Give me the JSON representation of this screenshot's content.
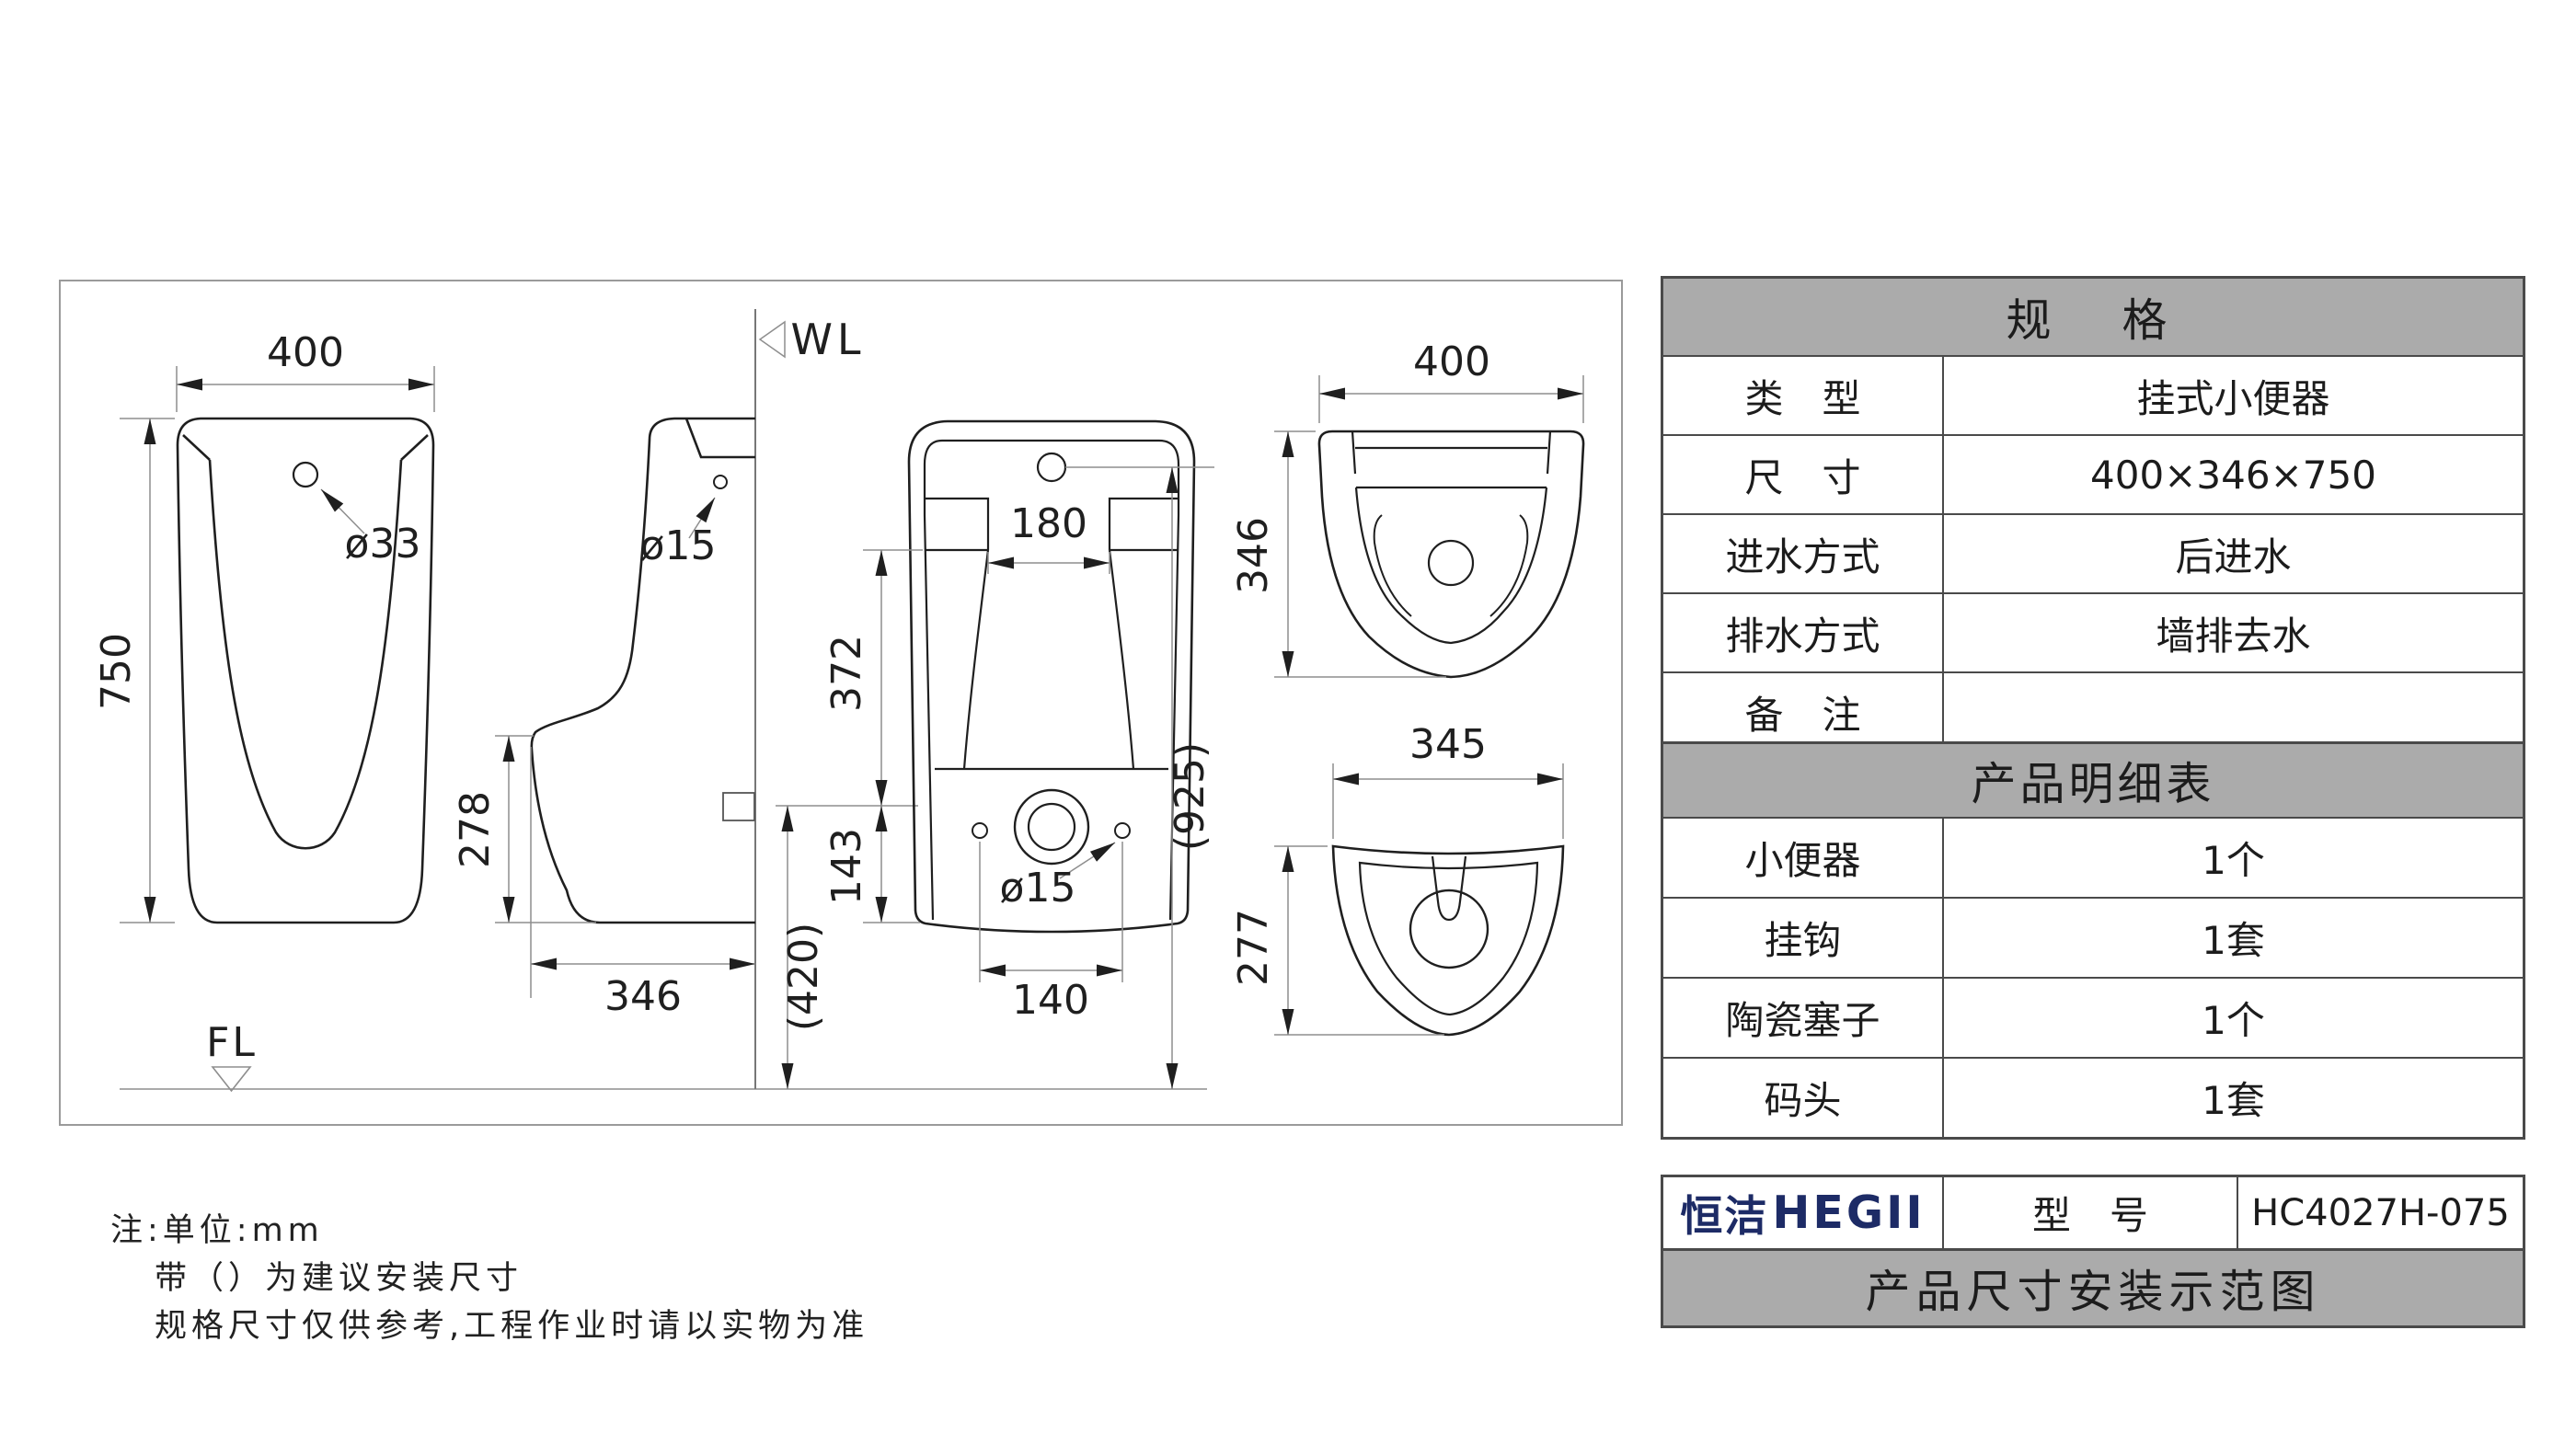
{
  "drawing": {
    "front_view": {
      "width": "400",
      "height": "750",
      "inlet_hole": "ø33",
      "floor_label": "FL"
    },
    "side_view": {
      "hole": "ø15",
      "depth_lower": "278",
      "bottom_depth": "346",
      "wall_label": "WL",
      "outlet_height": "(420)"
    },
    "rear_view": {
      "opening": "180",
      "upper": "372",
      "lower": "143",
      "holes": "ø15",
      "hole_spacing": "140",
      "inlet_height": "(925)"
    },
    "top_view": {
      "width": "400",
      "depth": "346"
    },
    "bottom_view": {
      "width": "345",
      "depth": "277"
    }
  },
  "spec_table": {
    "title": "规　格",
    "rows": [
      {
        "label": "类　型",
        "value": "挂式小便器"
      },
      {
        "label": "尺　寸",
        "value": "400×346×750"
      },
      {
        "label": "进水方式",
        "value": "后进水"
      },
      {
        "label": "排水方式",
        "value": "墙排去水"
      },
      {
        "label": "备　注",
        "value": ""
      }
    ]
  },
  "detail_table": {
    "title": "产品明细表",
    "rows": [
      {
        "label": "小便器",
        "value": "1个"
      },
      {
        "label": "挂钩",
        "value": "1套"
      },
      {
        "label": "陶瓷塞子",
        "value": "1个"
      },
      {
        "label": "码头",
        "value": "1套"
      }
    ]
  },
  "title_block": {
    "logo_cn": "恒洁",
    "logo_en": "HEGII",
    "model_label": "型　号",
    "model_value": "HC4027H-075",
    "caption": "产品尺寸安装示范图"
  },
  "notes": {
    "line1": "注:单位:mm",
    "line2": "带（）为建议安装尺寸",
    "line3": "规格尺寸仅供参考,工程作业时请以实物为准"
  },
  "colors": {
    "accent_navy": "#1d2b66",
    "header_gray": "#ababab",
    "line_dark": "#1f1f1f",
    "line_dim": "#8e8e8e"
  }
}
